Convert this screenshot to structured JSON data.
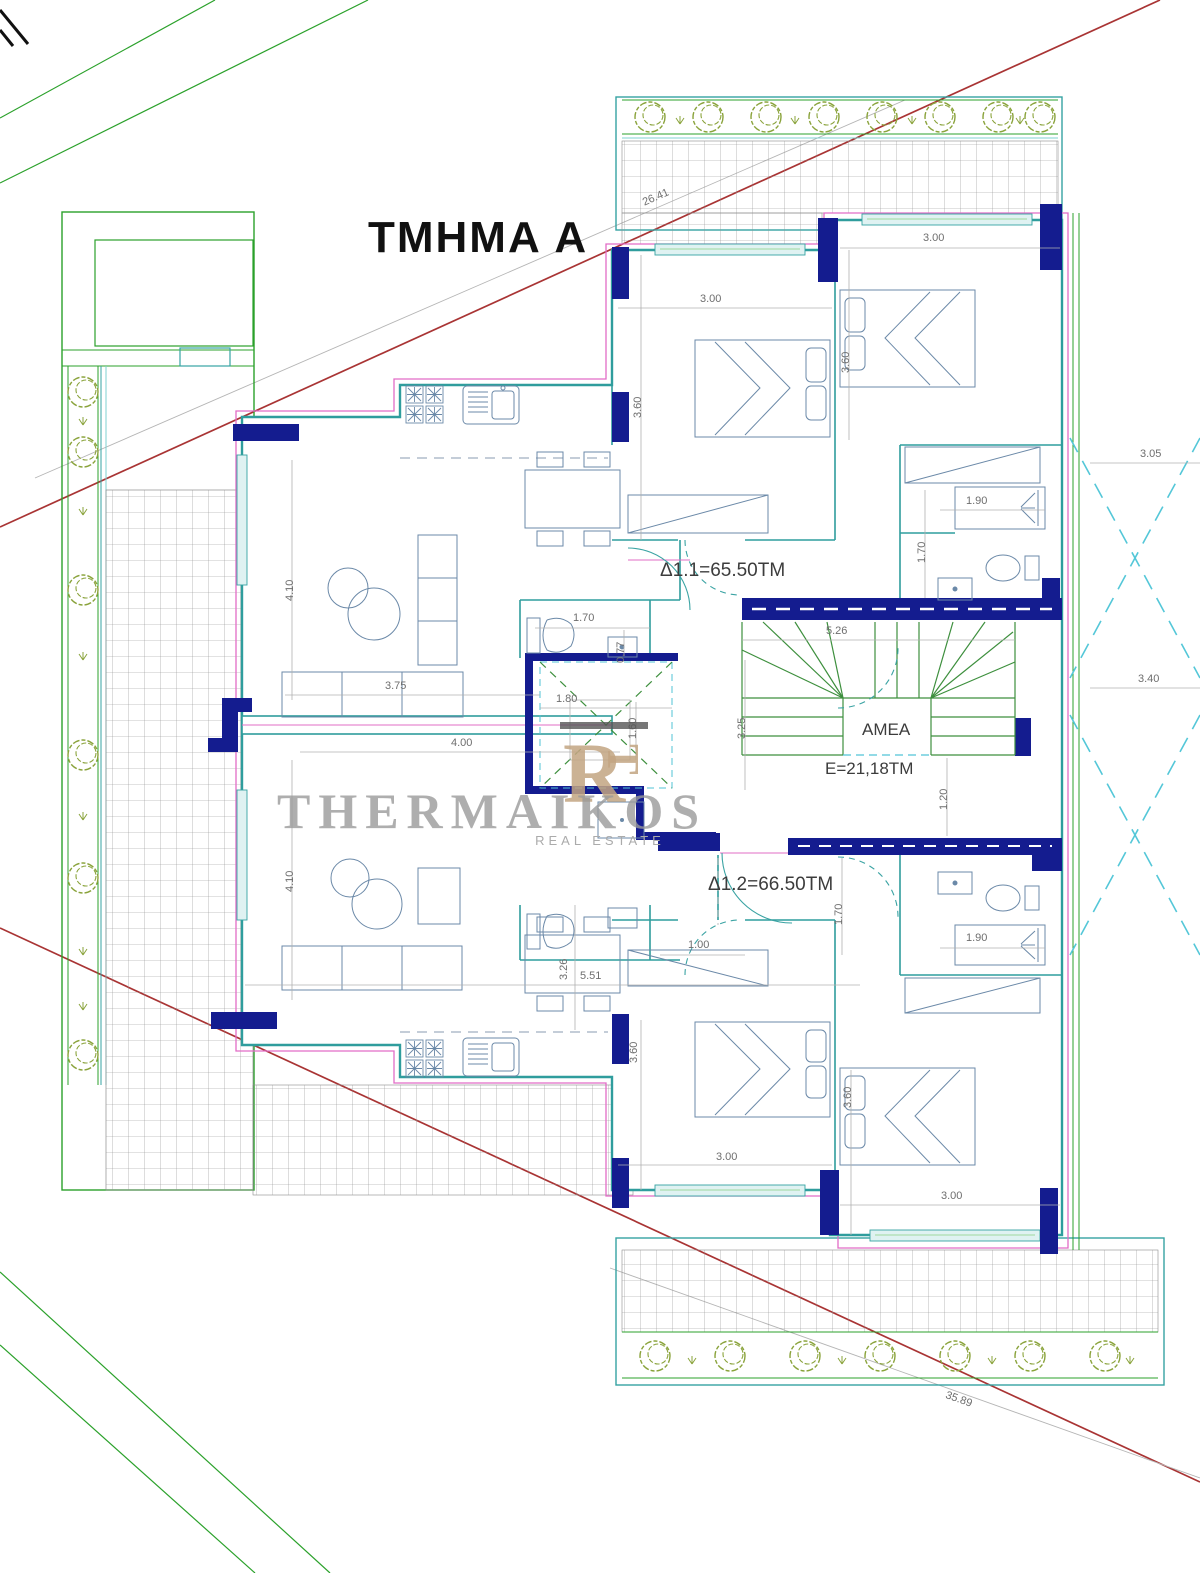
{
  "drawing": {
    "title": "ΤΜΗΜΑ Α",
    "units": {
      "d11": "Δ1.1=65.50ΤΜ",
      "d12": "Δ1.2=66.50ΤΜ"
    },
    "core": {
      "amea": "AMEA",
      "area": "Ε=21,18ΤΜ"
    },
    "site": {
      "front": "26.41",
      "rear": "35.89"
    },
    "dimensions": {
      "bed_tl_w": "3.00",
      "bed_tr_w": "3.00",
      "bed_bl_w": "3.00",
      "bed_br_w": "3.00",
      "bed_tl_h": "3.60",
      "bed_tr_h": "3.60",
      "bed_bl_h": "3.60",
      "bed_br_h": "3.60",
      "shower_top": "1.90",
      "shower_bot": "1.90",
      "bath_top_d": "1.70",
      "bath_bot_d": "1.70",
      "wc_top_w": "1.70",
      "wc_top_d": "0.77",
      "hall_bot_w": "1.00",
      "right_upper": "3.05",
      "right_lower": "3.40",
      "stair_w": "5.26",
      "stair_h": "3.25",
      "stair_r": "1.20",
      "lift_w": "1.80",
      "lift_h": "1.60",
      "liv_top_h": "4.10",
      "liv_bot_h": "4.10",
      "sofa_top": "3.75",
      "liv_bot_w": "4.00",
      "liv_bot_w2": "5.51",
      "din_bot_h": "3.26"
    },
    "watermark": {
      "brand": "THERMAIKOS",
      "tagline": "REAL ESTATE",
      "monogram_r": "R",
      "monogram_t": "T"
    },
    "colors": {
      "wall_navy": "#141c8f",
      "wall_teal": "#35a3a3",
      "landscape_green": "#2ba12b",
      "tree_olive": "#8aa33b",
      "slab_magenta": "#e26cc6",
      "boundary_red": "#a93434",
      "stair_green": "#3d8f3d",
      "watermark_tan": "#c3a582"
    }
  }
}
